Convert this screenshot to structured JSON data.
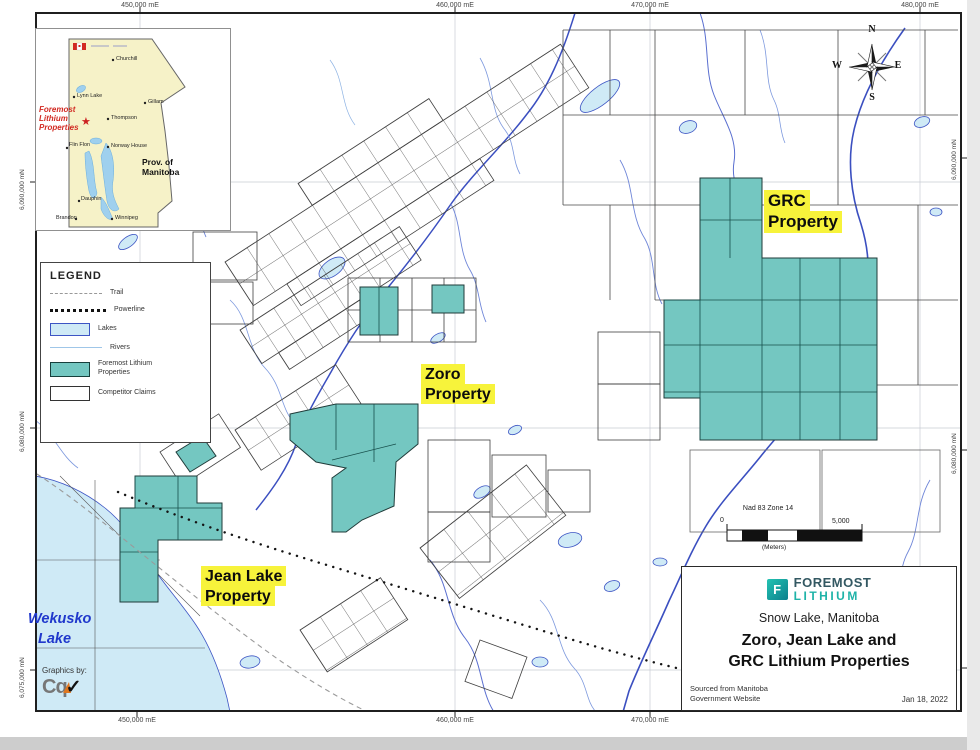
{
  "map": {
    "coords_top": [
      "450,000 mE",
      "460,000 mE",
      "470,000 mE",
      "480,000 mE"
    ],
    "coords_bottom": [
      "450,000 mE",
      "460,000 mE",
      "470,000 mE"
    ],
    "coords_left": [
      "6,090,000 mN",
      "6,080,000 mN",
      "6,075,000 mN"
    ],
    "coords_right": [
      "6,090,000 mN",
      "6,080,000 mN",
      "6,070,000 mN"
    ]
  },
  "inset": {
    "marker_label": "Foremost Lithium Properties",
    "marker_icon": "red-star",
    "province_line1": "Prov. of",
    "province_line2": "Manitoba",
    "cities": [
      "Churchill",
      "Lynn Lake",
      "Gillam",
      "Thompson",
      "Flin Flon",
      "Norway House",
      "Dauphin",
      "Brandon",
      "Winnipeg"
    ]
  },
  "legend": {
    "title": "LEGEND",
    "items": [
      {
        "label": "Trail"
      },
      {
        "label": "Powerline"
      },
      {
        "label": "Lakes"
      },
      {
        "label": "Rivers"
      },
      {
        "label": "Foremost Lithium Properties"
      },
      {
        "label": "Competitor Claims"
      }
    ]
  },
  "compass": {
    "n": "N",
    "e": "E",
    "s": "S",
    "w": "W"
  },
  "scalebar": {
    "datum": "Nad 83 Zone 14",
    "zero": "0",
    "max": "5,000",
    "units": "(Meters)"
  },
  "properties": {
    "grc_line1": "GRC",
    "grc_line2": "Property",
    "zoro_line1": "Zoro",
    "zoro_line2": "Property",
    "jean_line1": "Jean Lake",
    "jean_line2": "Property"
  },
  "water": {
    "wekusko_line1": "Wekusko",
    "wekusko_line2": "Lake"
  },
  "credits": {
    "label": "Graphics by:",
    "logo_text": "Cq",
    "check": "✓"
  },
  "title_block": {
    "logo_letter": "F",
    "brand_line1": "FOREMOST",
    "brand_line2": "LITHIUM",
    "location": "Snow Lake, Manitoba",
    "title_line1": "Zoro, Jean Lake and",
    "title_line2": "GRC Lithium Properties",
    "source_line1": "Sourced from Manitoba",
    "source_line2": "Government Website",
    "date": "Jan 18, 2022"
  },
  "colors": {
    "foremost_property": "#74c7c1",
    "lake_fill": "#cfeaf6",
    "river_blue": "#3b4fc0",
    "highlight_yellow": "#f7f33b",
    "brand_teal": "#1fb3a8",
    "brand_dark": "#335862",
    "marker_red": "#d22a22"
  }
}
